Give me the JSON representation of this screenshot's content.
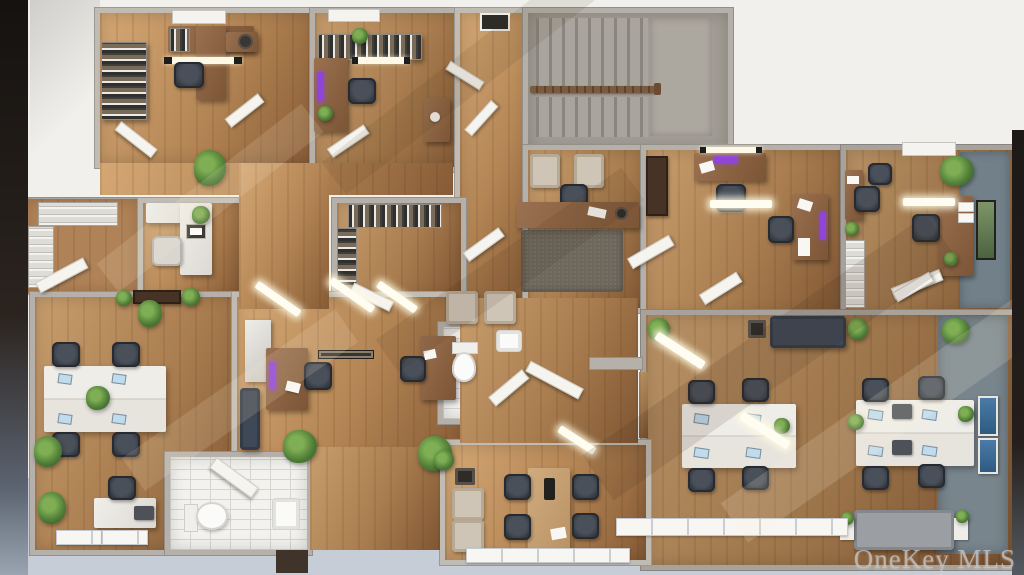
{
  "watermark": "OneKey MLS",
  "scene": {
    "type": "3d-floor-plan-rendering",
    "view": "top-down",
    "subject": "office-suite-floor-plan"
  },
  "rooms": [
    {
      "id": "private-office-top-left"
    },
    {
      "id": "private-office-top-mid"
    },
    {
      "id": "staircase"
    },
    {
      "id": "reception"
    },
    {
      "id": "private-office-mid-right"
    },
    {
      "id": "private-office-top-right"
    },
    {
      "id": "storage-room"
    },
    {
      "id": "small-office-left"
    },
    {
      "id": "file-room"
    },
    {
      "id": "open-workspace-left"
    },
    {
      "id": "open-area-center"
    },
    {
      "id": "bathroom-center"
    },
    {
      "id": "bathroom-bottom"
    },
    {
      "id": "meeting-room"
    },
    {
      "id": "open-office-right"
    }
  ],
  "colors": {
    "background": "#f2f0ec",
    "wall": "#b5b1aa",
    "wall_edge": "#93908a",
    "wood_light": "#c89e6e",
    "wood_mid": "#a97d4f",
    "wood_dark": "#7f5633",
    "tile": "#f3f2ef",
    "tile_line": "#d8d5d0",
    "exterior": "#c7cdd6",
    "photo_edge": "#16120f",
    "sofa_navy": "#3f4856",
    "sofa_gray": "#9b9ea2",
    "rug": "#6e675c",
    "stair_step": "#8a867f",
    "railing": "#7b5b3f",
    "accent_purple": "#9145d8",
    "screen_blue": "#bfdcee",
    "carpet_blue": "#78858c",
    "accent_wall": "#72808a",
    "watermark_color": "#c7c7cb"
  }
}
